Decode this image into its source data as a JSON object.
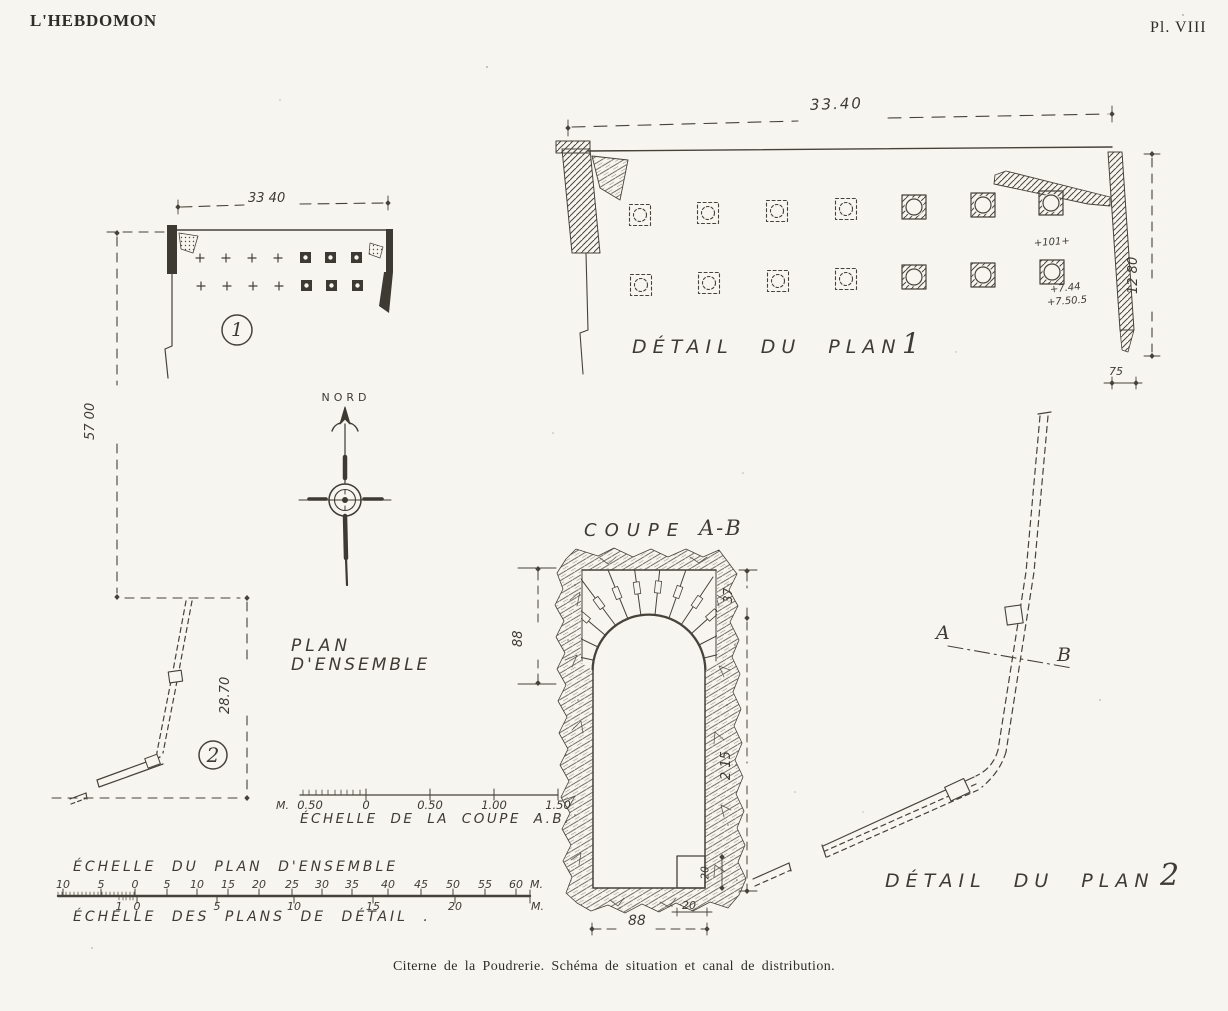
{
  "page": {
    "journal_title": "L'HEBDOMON",
    "plate_number": "Pl. VIII",
    "caption": "Citerne de la Poudrerie. Schéma de situation et canal de distribution.",
    "ink_color": "#45423a",
    "paper_color": "#f7f5ef"
  },
  "overview": {
    "title_line1": "PLAN",
    "title_line2": "D'ENSEMBLE",
    "north_label": "NORD",
    "dim_width": "33 40",
    "dim_site_height": "57 00",
    "dim_canal_length": "28.70",
    "badge_plan1": "1",
    "badge_plan2": "2"
  },
  "detail1": {
    "title": "DÉTAIL DU PLAN",
    "number": "1",
    "dim_width": "33.40",
    "dim_height": "12 80",
    "dim_wall_thickness": "75",
    "elev_top": "+101+",
    "elev_mid": "+7.44",
    "elev_bottom": "+7.50.5"
  },
  "coupe": {
    "title": "COUPE",
    "section_name": "A-B",
    "dim_vault_height": "88",
    "dim_crown": "37",
    "dim_total_height": "2 15",
    "dim_step_height": "20",
    "dim_step_width": "20",
    "dim_width": "88"
  },
  "detail2": {
    "title": "DÉTAIL DU PLAN",
    "number": "2",
    "point_a": "A",
    "point_b": "B"
  },
  "scale_coupe": {
    "unit_prefix": "M.",
    "ticks": [
      "0.50",
      "0",
      "0.50",
      "1.00",
      "1.50"
    ],
    "caption": "ÉCHELLE DE LA COUPE A.B."
  },
  "scale_ensemble": {
    "title": "ÉCHELLE DU PLAN D'ENSEMBLE",
    "ticks": [
      "10",
      "5",
      "0",
      "5",
      "10",
      "15",
      "20",
      "25",
      "30",
      "35",
      "40",
      "45",
      "50",
      "55",
      "60"
    ],
    "unit": "M."
  },
  "scale_detail": {
    "title": "ÉCHELLE DES PLANS DE DÉTAIL .",
    "ticks": [
      "1",
      "0",
      "5",
      "10",
      "15",
      "20"
    ],
    "unit": "M."
  }
}
